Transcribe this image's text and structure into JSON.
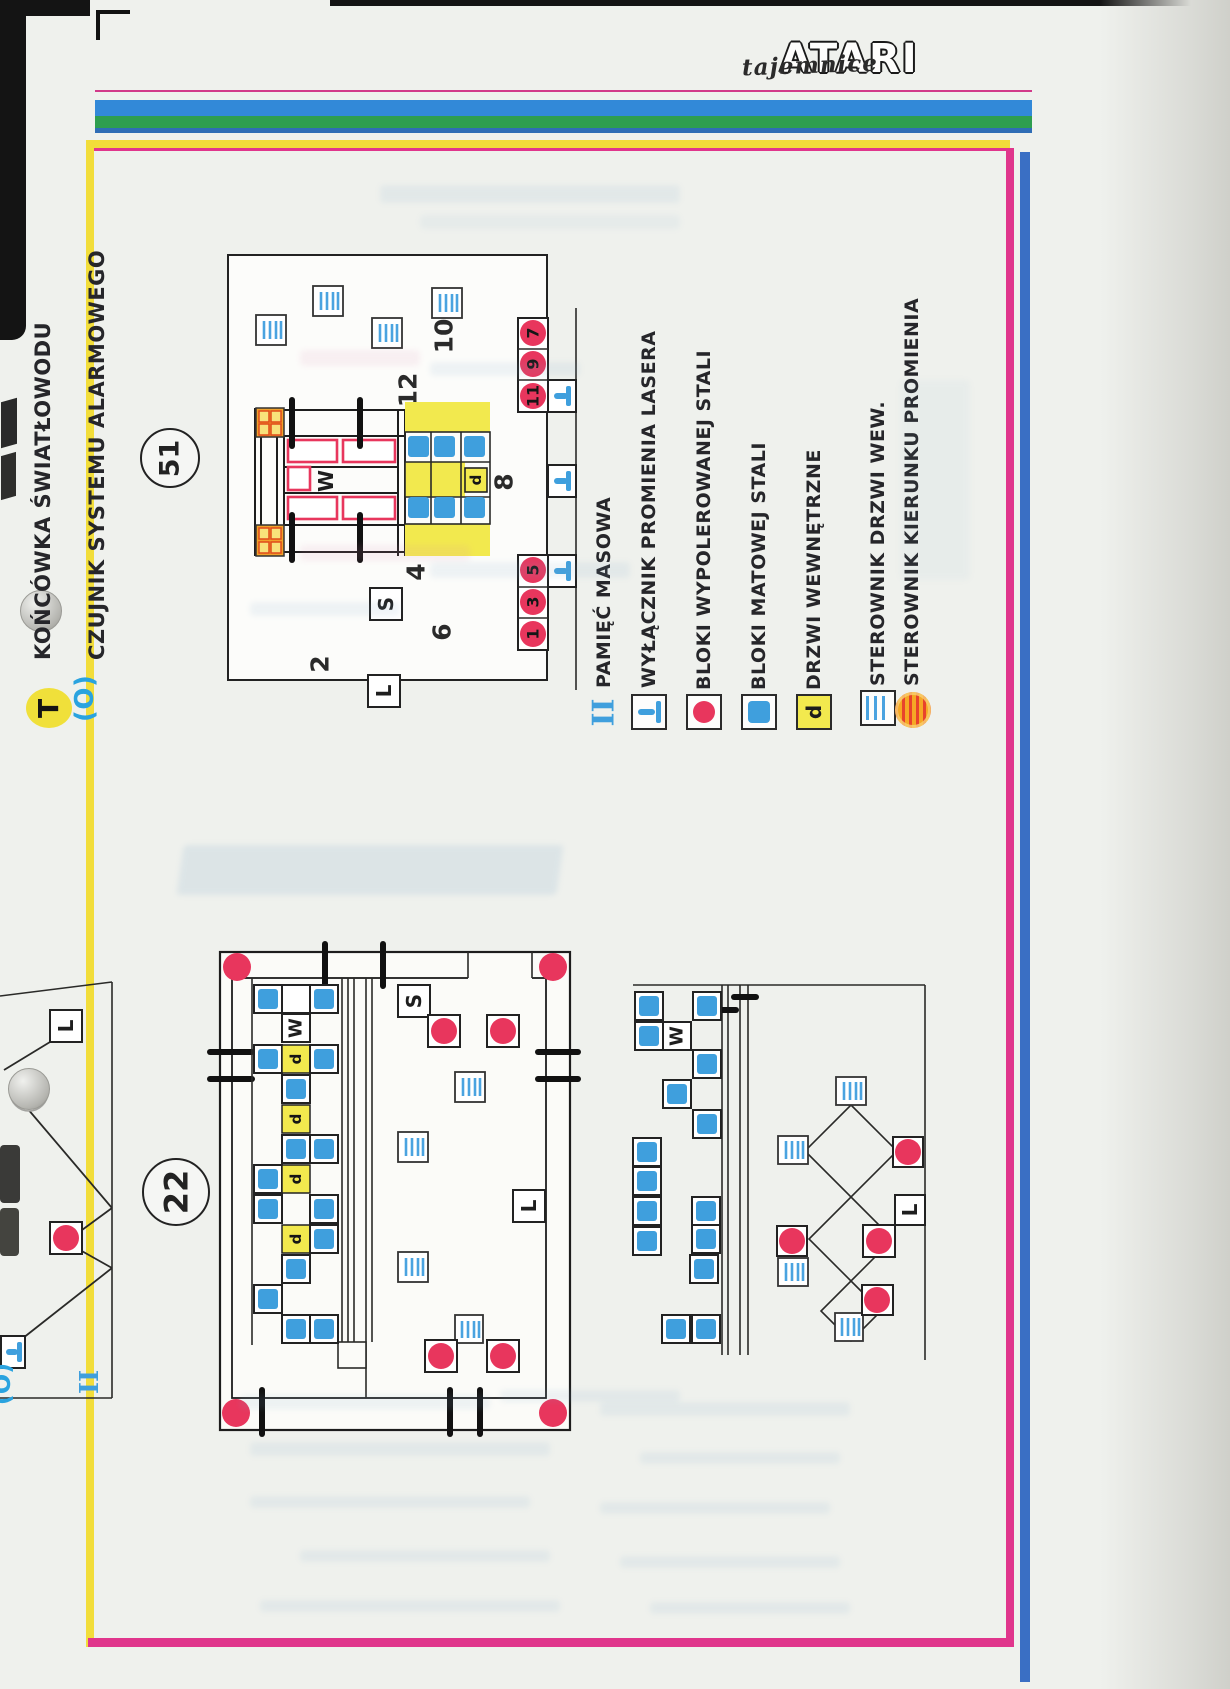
{
  "logo": {
    "script": "tajemnice",
    "brand": "ATARI"
  },
  "annotations": {
    "fiber_symbol": "T",
    "fiber_label": "KOŃCÓWKA ŚWIATŁOWODU",
    "alarm_symbol": "(O)",
    "alarm_label": "CZUJNIK SYSTEMU ALARMOWEGO"
  },
  "legend": {
    "items": [
      {
        "icon": "mass-storage-icon",
        "label": "PAMIĘĆ MASOWA"
      },
      {
        "icon": "laser-switch-icon",
        "label": "WYŁĄCZNIK PROMIENIA LASERA"
      },
      {
        "icon": "polished-steel-icon",
        "label": "BLOKI WYPOLEROWANEJ STALI"
      },
      {
        "icon": "matte-steel-icon",
        "label": "BLOKI MATOWEJ STALI"
      },
      {
        "icon": "inner-door-icon",
        "label": "DRZWI WEWNĘTRZNE"
      },
      {
        "icon": "door-controller-icon",
        "label": "STEROWNIK DRZWI WEW."
      },
      {
        "icon": "beam-direction-icon",
        "label": "STEROWNIK KIERUNKU PROMIENIA"
      }
    ],
    "roman_two": "II"
  },
  "map51": {
    "badge": "51",
    "room_numbers": {
      "n2": "2",
      "n4": "4",
      "n6": "6",
      "n8": "8",
      "n10": "10",
      "n12": "12"
    },
    "letters": {
      "W": "W",
      "S": "S",
      "L": "L",
      "d": "d"
    },
    "beam_points_right": [
      "7",
      "9",
      "11"
    ],
    "beam_points_bottom": [
      "5",
      "3",
      "1"
    ]
  },
  "map22": {
    "badge": "22",
    "letters": {
      "W": "W",
      "S": "S",
      "L": "L",
      "d": "d"
    },
    "annex_letter": "L",
    "roman_two": "II",
    "alarm_symbol": "(O)"
  },
  "map_right": {
    "letters": {
      "W": "W",
      "L": "L"
    }
  },
  "colors": {
    "steel_blue": "#3f9fdd",
    "beam_red": "#e8365d",
    "door_yellow": "#f2e94e",
    "frame_yellow": "#f2dd3a",
    "frame_magenta": "#e0368c",
    "frame_blue": "#3a6fc4",
    "stripe_blue": "#3289d8",
    "stripe_green": "#2e9e4f"
  }
}
